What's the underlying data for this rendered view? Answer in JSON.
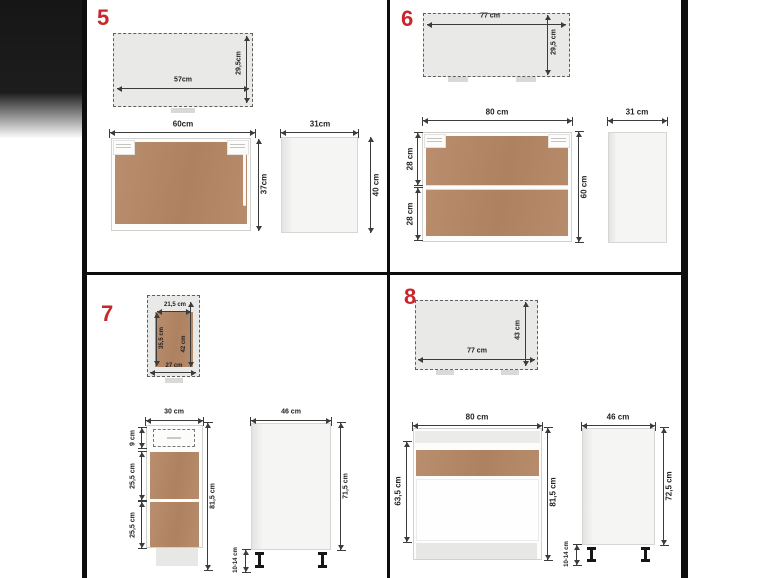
{
  "figure": {
    "title_numbers": [
      "5",
      "6",
      "7",
      "8"
    ],
    "items": [
      {
        "number": "5",
        "package": {
          "w": "57cm",
          "h": "29,5cm"
        },
        "front": {
          "w": "60cm",
          "h": "37cm"
        },
        "side": {
          "w": "31cm",
          "h": "40 cm"
        }
      },
      {
        "number": "6",
        "package": {
          "w": "77 cm",
          "h": "29,5 cm"
        },
        "front": {
          "w": "80 cm",
          "h": "60 cm",
          "section_top": "28 cm",
          "section_bottom": "28 cm"
        },
        "side": {
          "w": "31 cm"
        }
      },
      {
        "number": "7",
        "package": {
          "inner_w": "21,5 cm",
          "inner_h": "35,5 cm",
          "h": "42 cm",
          "w": "27 cm"
        },
        "front": {
          "w": "30 cm",
          "drawer_h": "9 cm",
          "section_top": "25,5 cm",
          "section_bottom": "25,5 cm",
          "h": "81,5 cm"
        },
        "side": {
          "w": "46 cm",
          "h": "71,5 cm",
          "legs": "10-14 cm"
        }
      },
      {
        "number": "8",
        "package": {
          "w": "77 cm",
          "h": "43 cm"
        },
        "front": {
          "w": "80 cm",
          "inner_h": "63,5 cm",
          "h": "81,5 cm"
        },
        "side": {
          "w": "46 cm",
          "h": "72,5 cm",
          "legs": "10-14 cm"
        }
      }
    ]
  },
  "colors": {
    "accent_red": "#c9262c",
    "wood_brown": "#b5886a",
    "panel_gray": "#e9e9e7",
    "dimension_line": "#3c3c3c",
    "frame_black": "#0d0d0d"
  }
}
